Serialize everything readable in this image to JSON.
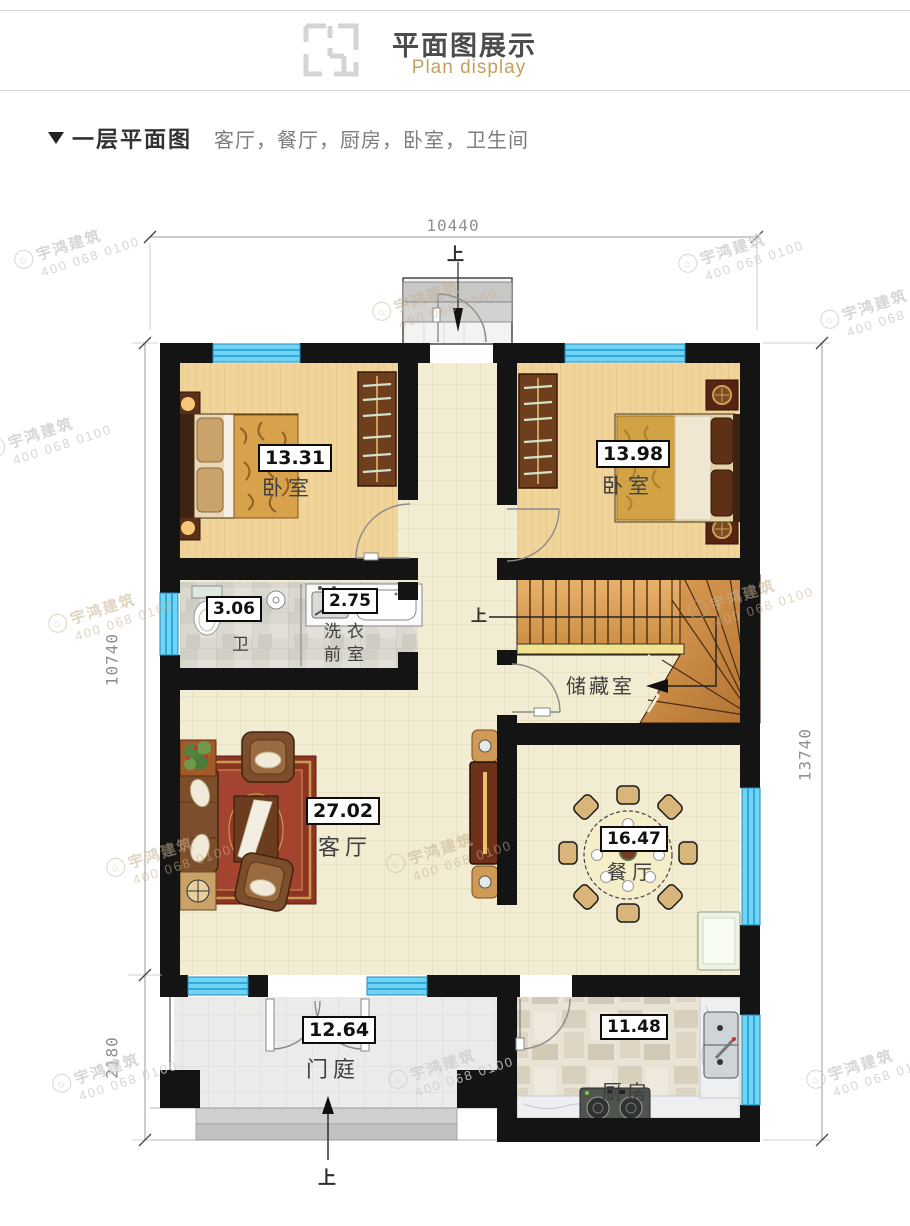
{
  "header": {
    "title": "平面图展示",
    "subtitle": "Plan display"
  },
  "section": {
    "title": "一层平面图",
    "rooms_list": "客厅，餐厅，厨房，卧室，卫生间"
  },
  "dimensions": {
    "top": "10440",
    "left_upper": "10740",
    "left_lower": "2180",
    "right": "13740"
  },
  "rooms": {
    "bedroom_left": {
      "name": "卧室",
      "area": "13.31"
    },
    "bedroom_right": {
      "name": "卧室",
      "area": "13.98"
    },
    "bathroom": {
      "name": "卫",
      "area": "3.06"
    },
    "laundry": {
      "name_line1": "洗衣",
      "name_line2": "前室",
      "area": "2.75"
    },
    "storage": {
      "name": "储藏室"
    },
    "living": {
      "name": "客厅",
      "area": "27.02"
    },
    "dining": {
      "name": "餐厅",
      "area": "16.47"
    },
    "foyer": {
      "name": "门庭",
      "area": "12.64"
    },
    "kitchen": {
      "name": "厨房",
      "area": "11.48"
    }
  },
  "annotations": {
    "up": "上"
  },
  "watermark": {
    "brand": "宇鸿建筑",
    "phone": "400 068 0100",
    "logo_glyph": "⌂",
    "positions": [
      [
        14,
        232,
        "gray"
      ],
      [
        678,
        236,
        "gray"
      ],
      [
        372,
        284,
        "tan"
      ],
      [
        820,
        292,
        "gray"
      ],
      [
        -14,
        420,
        "gray"
      ],
      [
        48,
        596,
        "tan"
      ],
      [
        688,
        582,
        "tan"
      ],
      [
        106,
        840,
        "tan"
      ],
      [
        386,
        836,
        "tan"
      ],
      [
        52,
        1056,
        "gray"
      ],
      [
        388,
        1052,
        "gray"
      ],
      [
        806,
        1052,
        "gray"
      ]
    ]
  },
  "colors": {
    "accent_gold": "#c3a05e",
    "wall": "#141414",
    "window": "#72d4f4"
  }
}
